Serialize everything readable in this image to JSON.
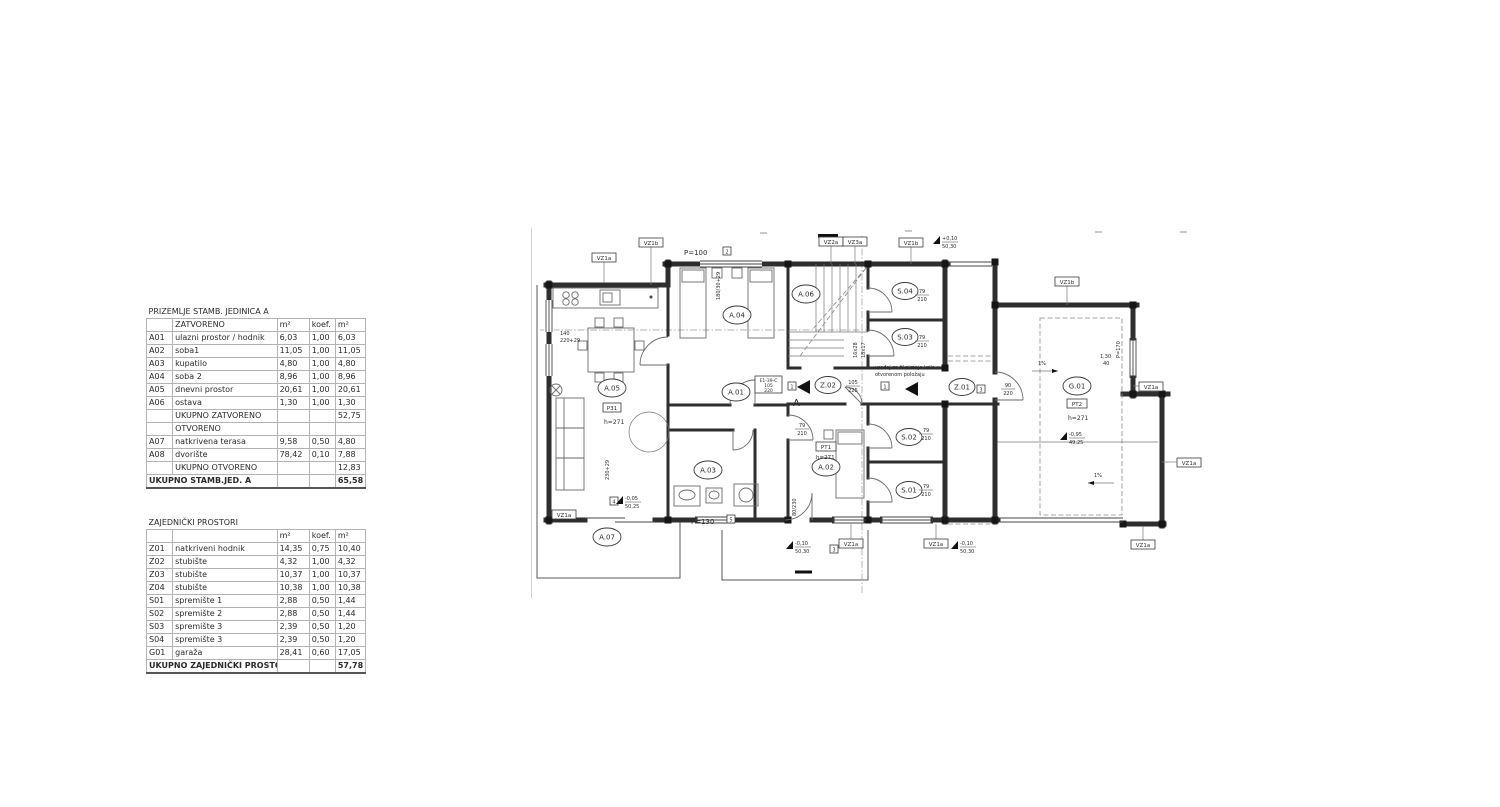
{
  "tables": [
    {
      "title": "PRIZEMLJE STAMB. JEDINICA A",
      "section_closed": "ZATVORENO",
      "section_open": "OTVORENO",
      "col_m2": "m²",
      "col_koef": "koef.",
      "rows_closed": [
        {
          "id": "A01",
          "name": "ulazni prostor / hodnik",
          "area": "6,03",
          "koef": "1,00",
          "result": "6,03"
        },
        {
          "id": "A02",
          "name": "soba1",
          "area": "11,05",
          "koef": "1,00",
          "result": "11,05"
        },
        {
          "id": "A03",
          "name": "kupatilo",
          "area": "4,80",
          "koef": "1,00",
          "result": "4,80"
        },
        {
          "id": "A04",
          "name": "soba 2",
          "area": "8,96",
          "koef": "1,00",
          "result": "8,96"
        },
        {
          "id": "A05",
          "name": "dnevni prostor",
          "area": "20,61",
          "koef": "1,00",
          "result": "20,61"
        },
        {
          "id": "A06",
          "name": "ostava",
          "area": "1,30",
          "koef": "1,00",
          "result": "1,30"
        }
      ],
      "subtotal_closed": {
        "label": "UKUPNO ZATVORENO",
        "value": "52,75"
      },
      "rows_open": [
        {
          "id": "A07",
          "name": "natkrivena terasa",
          "area": "9,58",
          "koef": "0,50",
          "result": "4,80"
        },
        {
          "id": "A08",
          "name": "dvorište",
          "area": "78,42",
          "koef": "0,10",
          "result": "7,88"
        }
      ],
      "subtotal_open": {
        "label": "UKUPNO OTVORENO",
        "value": "12,83"
      },
      "total": {
        "label": "UKUPNO STAMB.JED. A",
        "value": "65,58"
      }
    },
    {
      "title": "ZAJEDNIČKI PROSTORI",
      "col_m2": "m²",
      "col_koef": "koef.",
      "rows": [
        {
          "id": "Z01",
          "name": "natkriveni hodnik",
          "area": "14,35",
          "koef": "0,75",
          "result": "10,40"
        },
        {
          "id": "Z02",
          "name": "stubište",
          "area": "4,32",
          "koef": "1,00",
          "result": "4,32"
        },
        {
          "id": "Z03",
          "name": "stubište",
          "area": "10,37",
          "koef": "1,00",
          "result": "10,37"
        },
        {
          "id": "Z04",
          "name": "stubište",
          "area": "10,38",
          "koef": "1,00",
          "result": "10,38"
        },
        {
          "id": "S01",
          "name": "spremište 1",
          "area": "2,88",
          "koef": "0,50",
          "result": "1,44"
        },
        {
          "id": "S02",
          "name": "spremište 2",
          "area": "2,88",
          "koef": "0,50",
          "result": "1,44"
        },
        {
          "id": "S03",
          "name": "spremište 3",
          "area": "2,39",
          "koef": "0,50",
          "result": "1,20"
        },
        {
          "id": "S04",
          "name": "spremište 3",
          "area": "2,39",
          "koef": "0,50",
          "result": "1,20"
        },
        {
          "id": "G01",
          "name": "garaža",
          "area": "28,41",
          "koef": "0,60",
          "result": "17,05"
        }
      ],
      "total": {
        "label": "UKUPNO ZAJEDNIČKI PROSTORI",
        "value": "57,78"
      }
    }
  ],
  "plan": {
    "rooms": {
      "a01": "A.01",
      "a02": "A.02",
      "a03": "A.03",
      "a04": "A.04",
      "a05": "A.05",
      "a06": "A.06",
      "a07": "A.07",
      "s01": "S.01",
      "s02": "S.02",
      "s03": "S.03",
      "s04": "S.04",
      "z01": "Z.01",
      "z02": "Z.02",
      "g01": "G.01"
    },
    "tags": {
      "vz1a": "VZ1a",
      "vz1b": "VZ1b",
      "vz2a": "VZ2a",
      "vz3a": "VZ3a",
      "pt1": "PT1",
      "pt2": "PT2",
      "p31": "P31",
      "e1_line1": "E1-39-C",
      "e1_line2": "105",
      "e1_line3": "220",
      "n1": "1",
      "n2": "2",
      "n3": "3",
      "n4": "4",
      "n5": "5"
    },
    "texts": {
      "p100": "P=100",
      "p130": "P=130",
      "p170": "P=170",
      "h271": "h=271",
      "slope": "1%",
      "stair_a": "16x28",
      "stair_b": "18x17",
      "sec_a": "A",
      "win_left_a": "140",
      "win_left_b": "220+29",
      "win_bottom": "230+29",
      "win_top": "180/30+29",
      "door79a": "79",
      "door79b": "210",
      "door105a": "105",
      "door105b": "225",
      "door90a": "90",
      "door90b": "220",
      "door80": "80/230",
      "dim130": "1,30",
      "dim40": "40",
      "note_l1": "uređaj za fiksiranje krila u",
      "note_l2": "otvorenom položaju"
    },
    "levels": {
      "top_v": "+0,10",
      "top_d": "50,30",
      "bot_v": "-0,10",
      "bot_d": "50,30",
      "left_v": "-0,05",
      "left_d": "50,25",
      "gar_v": "-0,95",
      "gar_d": "49,25"
    }
  }
}
